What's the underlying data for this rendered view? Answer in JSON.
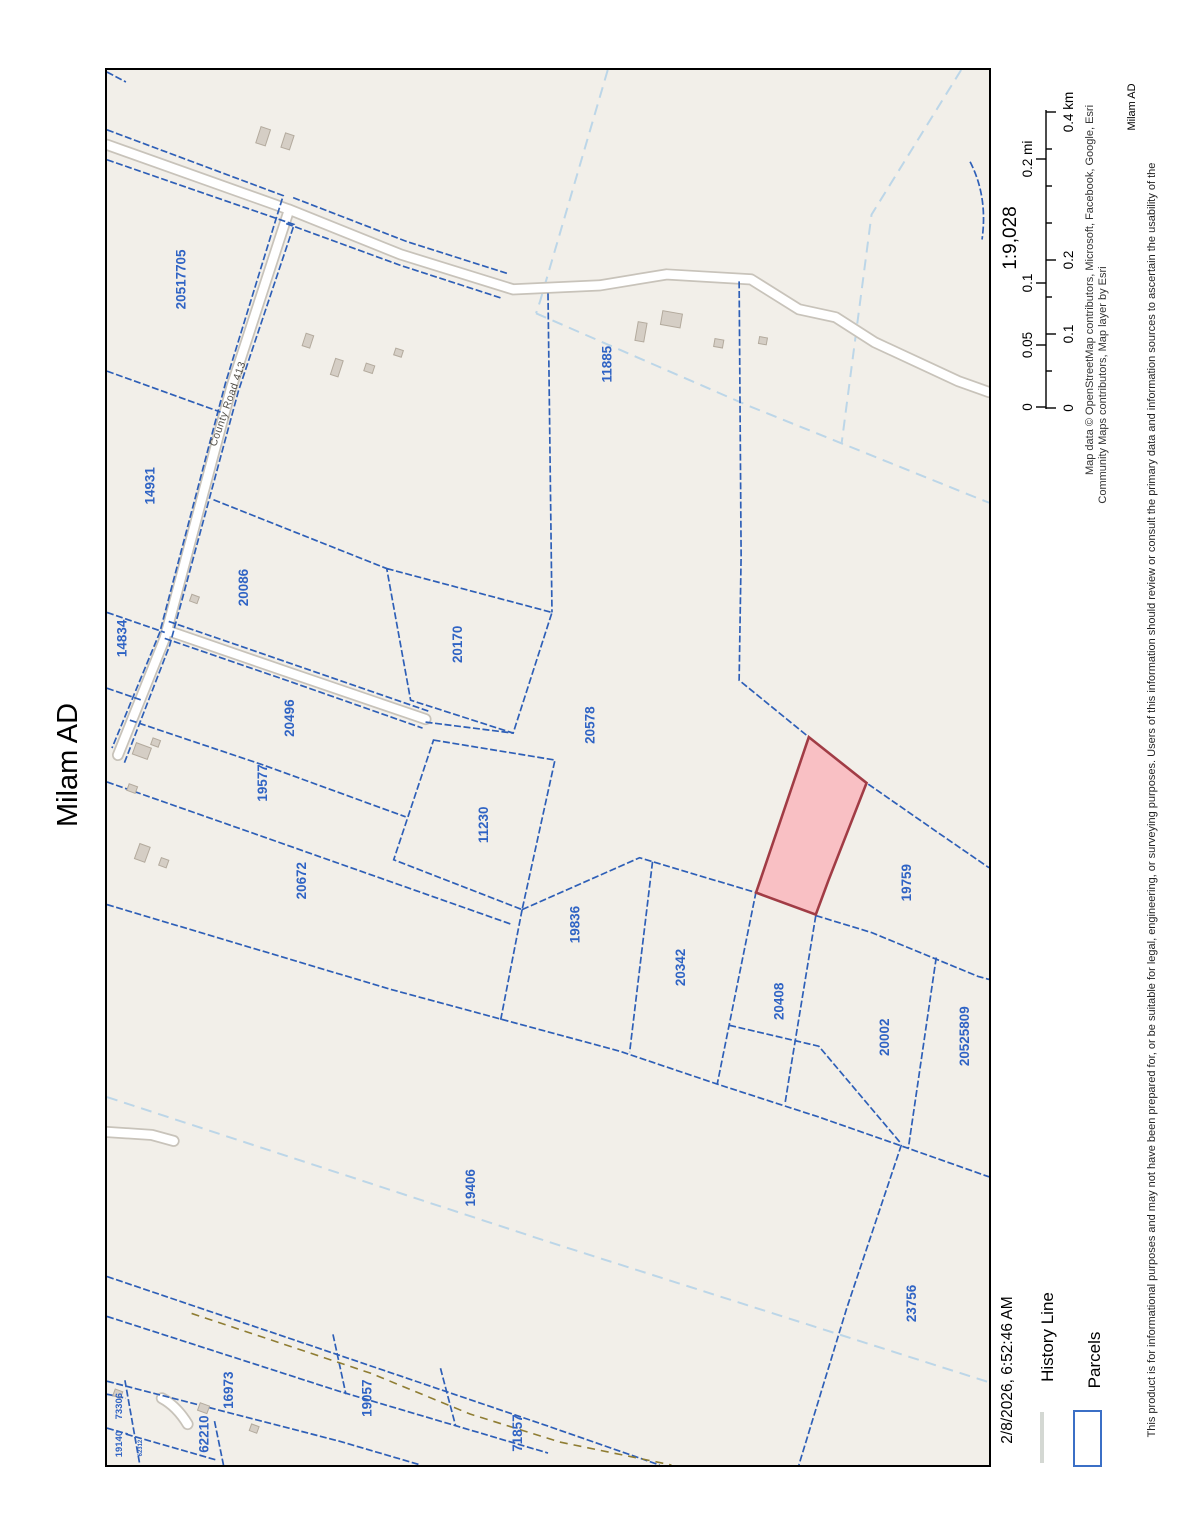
{
  "page": {
    "title": "Milam AD",
    "title_small": "Milam AD",
    "date": "2/8/2026, 6:52:46 AM"
  },
  "map": {
    "road_label": "County Road 413",
    "highlight_color": "#f9c0c4",
    "parcel_line_color": "#2e5fb7",
    "parcels": [
      {
        "label": "20517705",
        "x": 179,
        "y": 278
      },
      {
        "label": "14931",
        "x": 148,
        "y": 485
      },
      {
        "label": "14834",
        "x": 120,
        "y": 638
      },
      {
        "label": "20086",
        "x": 242,
        "y": 587
      },
      {
        "label": "20170",
        "x": 457,
        "y": 644
      },
      {
        "label": "11885",
        "x": 607,
        "y": 363
      },
      {
        "label": "20496",
        "x": 288,
        "y": 718
      },
      {
        "label": "19577",
        "x": 261,
        "y": 783
      },
      {
        "label": "20672",
        "x": 300,
        "y": 881
      },
      {
        "label": "11230",
        "x": 483,
        "y": 825
      },
      {
        "label": "20578",
        "x": 590,
        "y": 725
      },
      {
        "label": "19836",
        "x": 575,
        "y": 925
      },
      {
        "label": "20342",
        "x": 681,
        "y": 968
      },
      {
        "label": "20408",
        "x": 780,
        "y": 1002
      },
      {
        "label": "20002",
        "x": 886,
        "y": 1038
      },
      {
        "label": "19759",
        "x": 908,
        "y": 883
      },
      {
        "label": "20525809",
        "x": 966,
        "y": 1037
      },
      {
        "label": "19406",
        "x": 470,
        "y": 1189
      },
      {
        "label": "23756",
        "x": 913,
        "y": 1305
      },
      {
        "label": "16973",
        "x": 227,
        "y": 1392
      },
      {
        "label": "19057",
        "x": 366,
        "y": 1400
      },
      {
        "label": "62210",
        "x": 202,
        "y": 1436
      },
      {
        "label": "71857",
        "x": 517,
        "y": 1435
      },
      {
        "label": "73306",
        "x": 117,
        "y": 1408,
        "size": 9.5
      },
      {
        "label": "19140",
        "x": 117,
        "y": 1446,
        "size": 9.5
      },
      {
        "label": "62312",
        "x": 138,
        "y": 1450,
        "size": 6
      }
    ]
  },
  "scale": {
    "ratio": "1:9,028",
    "mi_labels": [
      "0",
      "0.05",
      "0.1",
      "0.2 mi"
    ],
    "km_labels": [
      "0",
      "0.1",
      "0.2",
      "0.4 km"
    ]
  },
  "attribution": {
    "line1": "Map data © OpenStreetMap contributors, Microsoft, Facebook, Google, Esri",
    "line2": "Community Maps contributors, Map layer by Esri"
  },
  "disclaimer": "This product is for informational purposes and may not have been prepared for, or be suitable for legal, engineering, or surveying purposes. Users of this information should review or consult the primary data and information sources to ascertain the usability of the",
  "legend": {
    "items": [
      {
        "label": "History Line"
      },
      {
        "label": "Parcels"
      }
    ]
  }
}
